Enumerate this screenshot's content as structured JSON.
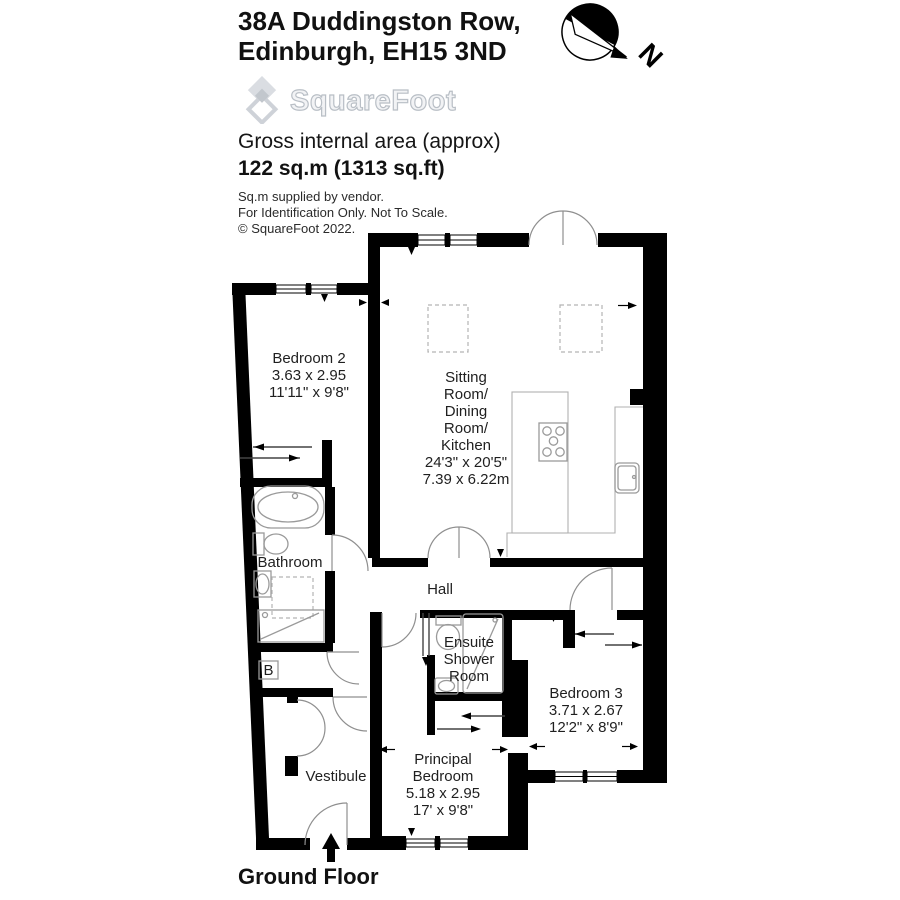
{
  "header": {
    "address_line1": "38A Duddingston Row,",
    "address_line2": "Edinburgh, EH15 3ND",
    "logo_text": "SquareFoot",
    "area_label": "Gross internal area (approx)",
    "area_value": "122 sq.m (1313 sq.ft)",
    "note1": "Sq.m supplied by vendor.",
    "note2": "For Identification Only. Not To Scale.",
    "note3": "© SquareFoot 2022."
  },
  "compass": {
    "north_label": "N"
  },
  "rooms": {
    "bedroom2": {
      "name": "Bedroom 2",
      "dims_m": "3.63 x 2.95",
      "dims_ft": "11'11\" x 9'8\""
    },
    "sitting": {
      "name_l1": "Sitting",
      "name_l2": "Room/",
      "name_l3": "Dining",
      "name_l4": "Room/",
      "name_l5": "Kitchen",
      "dims_ft": "24'3\" x 20'5\"",
      "dims_m": "7.39 x 6.22m"
    },
    "bathroom": {
      "name": "Bathroom"
    },
    "hall": {
      "name": "Hall"
    },
    "ensuite": {
      "name_l1": "Ensuite",
      "name_l2": "Shower",
      "name_l3": "Room"
    },
    "bedroom3": {
      "name": "Bedroom 3",
      "dims_m": "3.71 x 2.67",
      "dims_ft": "12'2\" x 8'9\""
    },
    "vestibule": {
      "name": "Vestibule"
    },
    "principal": {
      "name_l1": "Principal",
      "name_l2": "Bedroom",
      "dims_m": "5.18 x 2.95",
      "dims_ft": "17' x 9'8\""
    },
    "boiler": {
      "label": "B"
    }
  },
  "footer": {
    "floor_label": "Ground Floor"
  }
}
